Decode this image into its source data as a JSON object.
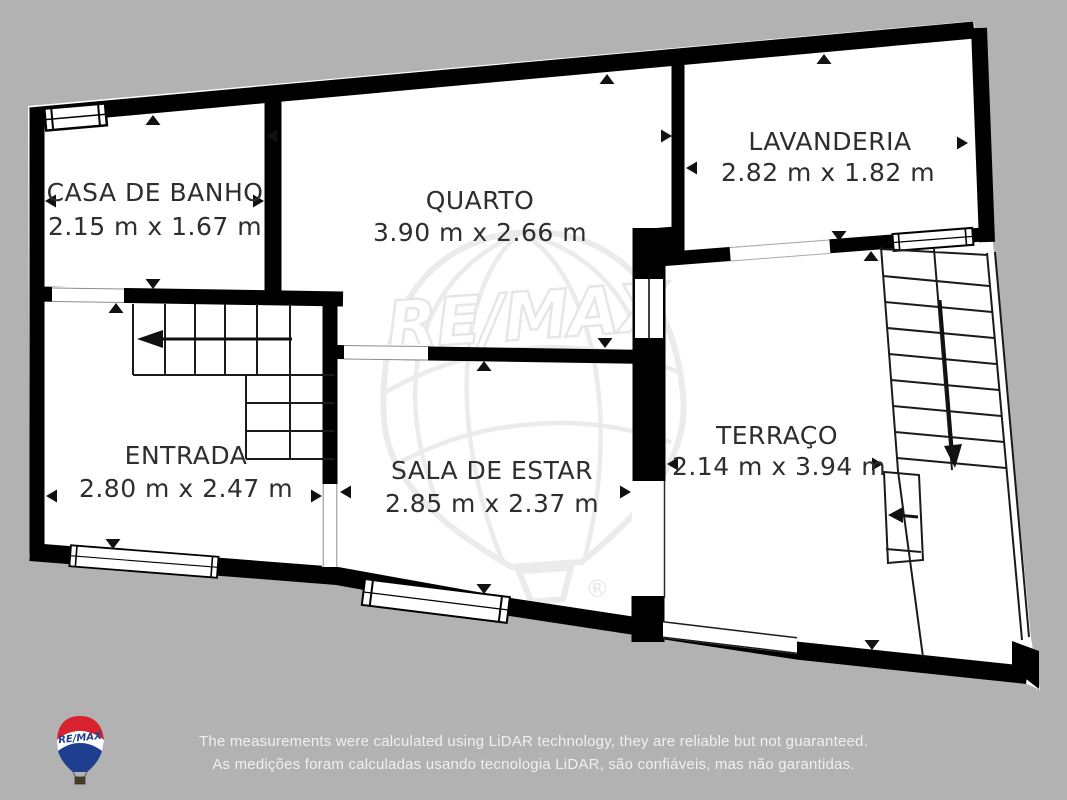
{
  "rooms": [
    {
      "id": "casa-de-banho",
      "name": "CASA DE BANHO",
      "dims": "2.15 m x 1.67 m"
    },
    {
      "id": "quarto",
      "name": "QUARTO",
      "dims": "3.90 m x 2.66 m"
    },
    {
      "id": "lavanderia",
      "name": "LAVANDERIA",
      "dims": "2.82 m x 1.82 m"
    },
    {
      "id": "entrada",
      "name": "ENTRADA",
      "dims": "2.80 m x 2.47 m"
    },
    {
      "id": "sala-de-estar",
      "name": "SALA DE ESTAR",
      "dims": "2.85 m x 2.37 m"
    },
    {
      "id": "terraco",
      "name": "TERRAÇO",
      "dims": "2.14 m x 3.94 m"
    }
  ],
  "watermark": {
    "text": "RE/MAX",
    "registered_mark": "®"
  },
  "logo": {
    "text": "RE/MAX"
  },
  "disclaimer": {
    "line1_en": "The measurements were calculated using LiDAR technology, they are reliable but not guaranteed.",
    "line2_pt": "As medições foram calculadas usando tecnologia LiDAR, são confiáveis, mas não garantidas."
  },
  "colors": {
    "background": "#b2b2b2",
    "floor": "#ffffff",
    "wall": "#000000",
    "label_text": "#2e2e2e",
    "watermark_line": "#ebebeb",
    "disclaimer_text": "#f0f0f0",
    "logo_red": "#D6232E",
    "logo_blue": "#1E3E90"
  }
}
